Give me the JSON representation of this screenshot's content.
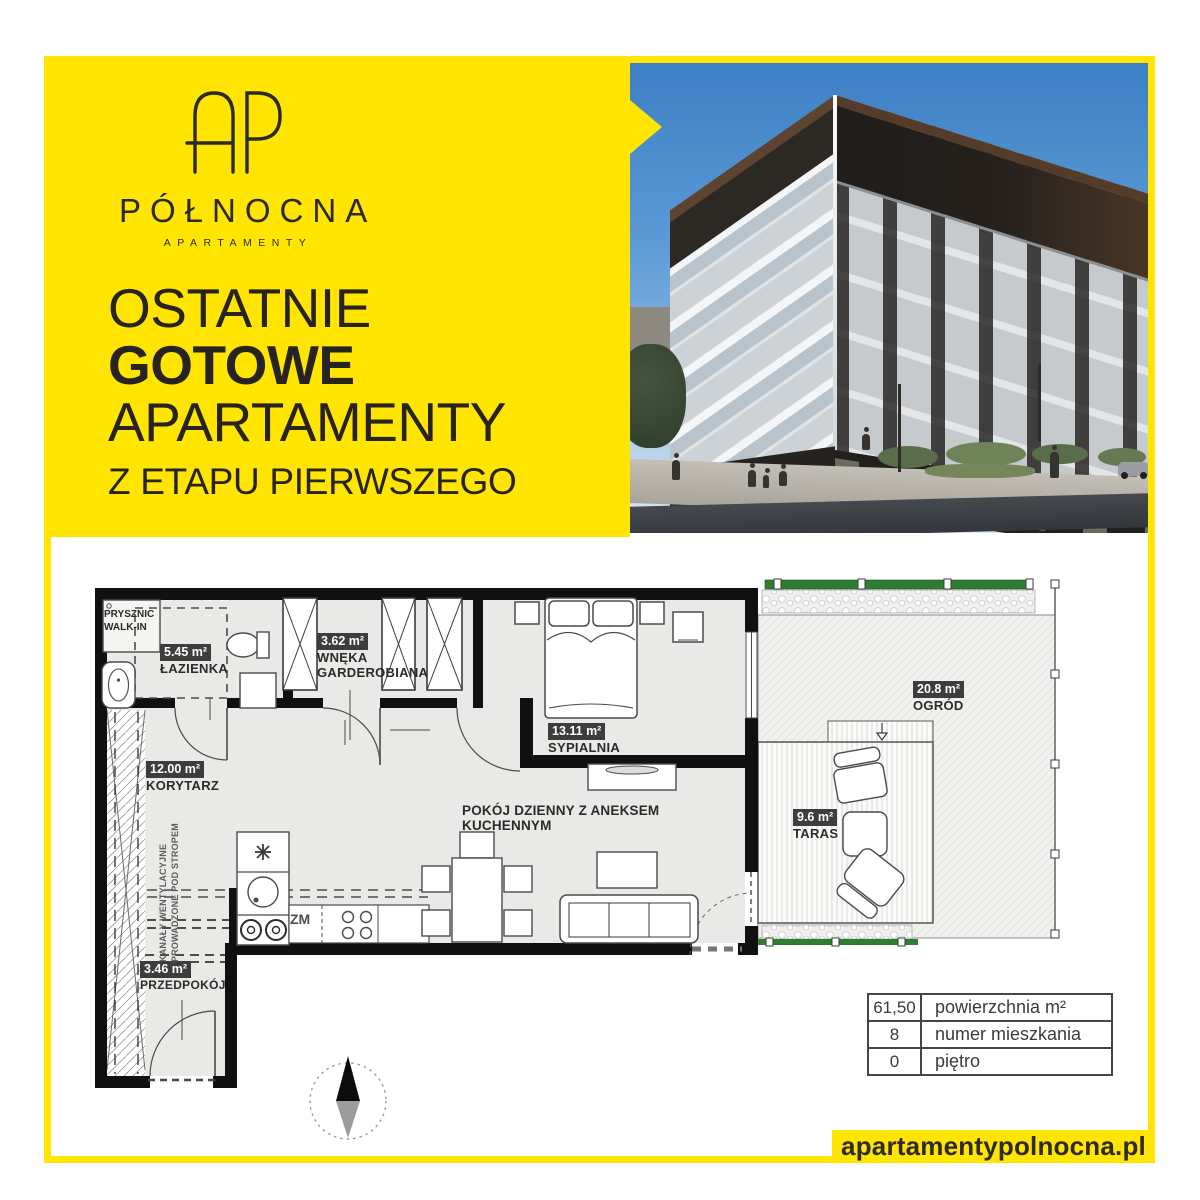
{
  "brand": {
    "logo_monogram": "AP",
    "name": "PÓŁNOCNA",
    "subtitle": "APARTAMENTY"
  },
  "headline": {
    "line1": "OSTATNIE",
    "line2": "GOTOWE",
    "line3": "APARTAMENTY",
    "line4": "Z ETAPU PIERWSZEGO"
  },
  "plan": {
    "rooms": [
      {
        "area": "5.45 m²",
        "name": "ŁAZIENKA"
      },
      {
        "area": "3.62 m²",
        "name": "WNĘKA GARDEROBIANA"
      },
      {
        "area": "12.00 m²",
        "name": "KORYTARZ"
      },
      {
        "area": "13.11 m²",
        "name": "SYPIALNIA"
      },
      {
        "name": "POKÓJ DZIENNY Z ANEKSEM KUCHENNYM"
      },
      {
        "area": "3.46 m²",
        "name": "PRZEDPOKÓJ"
      },
      {
        "area": "9.6 m²",
        "name": "TARAS"
      },
      {
        "area": "20.8 m²",
        "name": "OGRÓD"
      }
    ],
    "annotations": {
      "shower": "PRYSZNIC WALK-IN",
      "dishwasher": "ZM",
      "vent_line1": "KANAŁY WENTYLACYJNE",
      "vent_line2": "PROWADZONE POD STROPEM"
    }
  },
  "info_table": {
    "rows": [
      {
        "value": "61,50",
        "label": "powierzchnia m²"
      },
      {
        "value": "8",
        "label": "numer mieszkania"
      },
      {
        "value": "0",
        "label": "piętro"
      }
    ]
  },
  "footer": {
    "website": "apartamentypolnocna.pl"
  },
  "colors": {
    "brand_yellow": "#FFE500",
    "ink": "#2B2A29",
    "area_badge": "#3D3D3C",
    "hedge_green": "#2F7D33"
  }
}
